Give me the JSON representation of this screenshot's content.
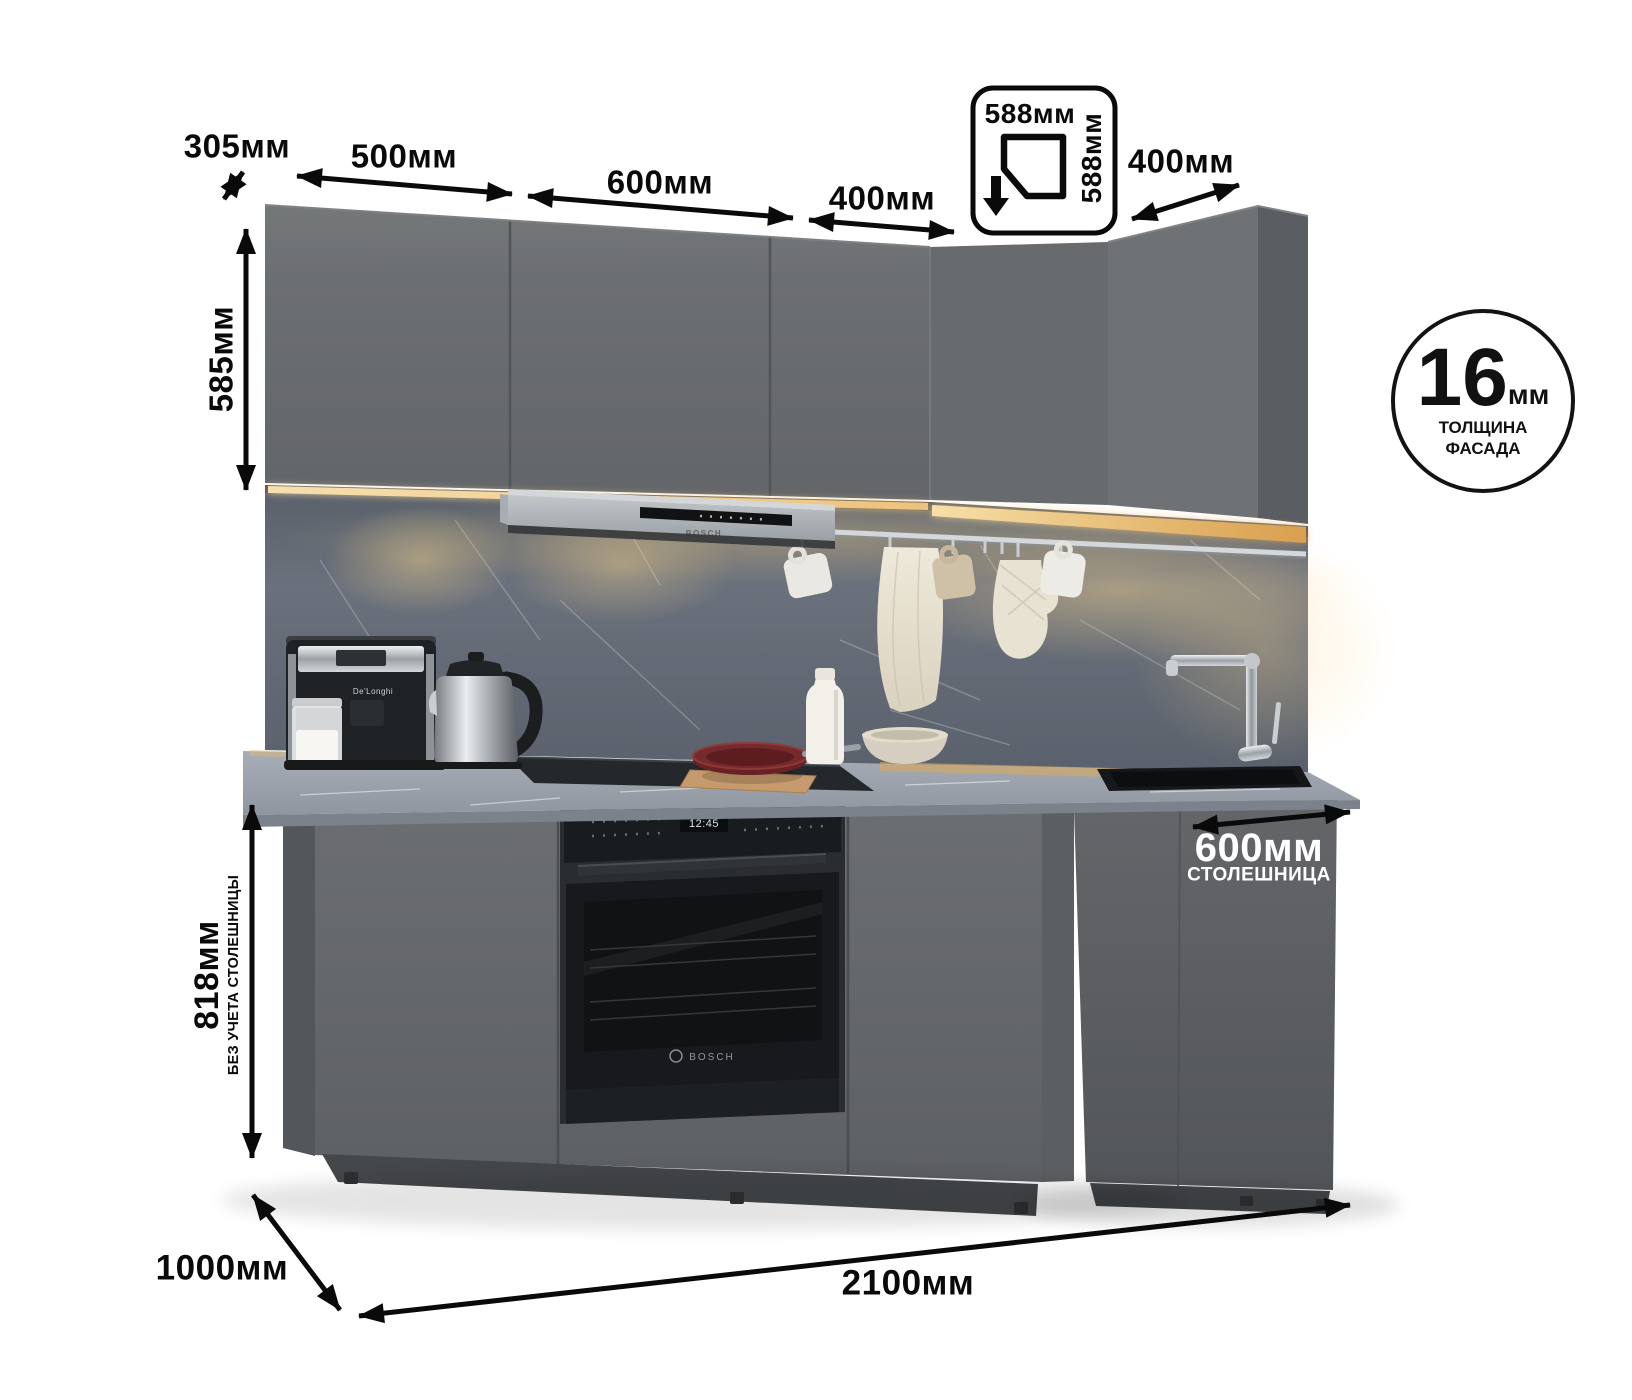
{
  "annotations": {
    "top_depth": "305мм",
    "w500": "500мм",
    "w600": "600мм",
    "w400_left": "400мм",
    "w400_right": "400мм",
    "corner_box": {
      "top": "588мм",
      "side": "588мм"
    },
    "upper_height": "585мм",
    "base_height": "818мм",
    "base_height_note": "БЕЗ УЧЕТА СТОЛЕШНИЦЫ",
    "counter_depth": "600мм",
    "counter_depth_note": "СТОЛЕШНИЦА",
    "left_depth": "1000мм",
    "total_width": "2100мм",
    "facade": {
      "value": "16",
      "unit": "мм",
      "caption_line1": "ТОЛЩИНА",
      "caption_line2": "ФАСАДА"
    }
  },
  "scene": {
    "oven": {
      "brand": "BOSCH",
      "clock": "12:45"
    },
    "hood": {
      "brand": "BOSCH"
    },
    "coffee_machine": {
      "brand": "De'Longhi"
    },
    "colors": {
      "cabinet": "#696c6f",
      "cabinet_side": "#55585b",
      "backsplash": "#636a75",
      "countertop": "#9ba2ac",
      "led_glow": "#f0cc8d",
      "hood_silver": "#b7bcc0",
      "appliance_black": "#1d2023",
      "pan_red": "#6e2227",
      "annotation": "#0a0a0a"
    }
  }
}
